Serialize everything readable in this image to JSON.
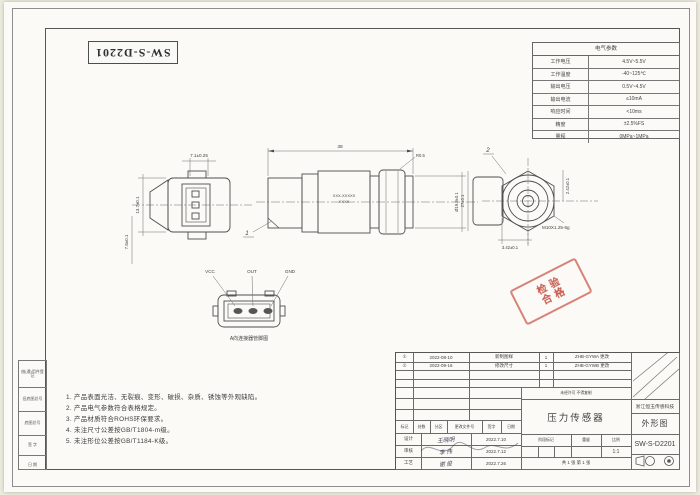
{
  "sheet": {
    "rotated_drawing_number": "SW-S-D2201",
    "line_color": "#4c4c4c",
    "stamp_color": "#c0392b"
  },
  "electrical_table": {
    "title": "电气参数",
    "rows": [
      [
        "工作电压",
        "4.5V~5.5V"
      ],
      [
        "工作温度",
        "-40~125℃"
      ],
      [
        "输出电压",
        "0.5V~4.5V"
      ],
      [
        "输出电流",
        "≤10mA"
      ],
      [
        "响应时间",
        "<10ms"
      ],
      [
        "精度",
        "±2.5%FS"
      ],
      [
        "量程",
        "0MPa~1MPa"
      ]
    ]
  },
  "views": {
    "left_view": {
      "dim_top": "7.1±0.25",
      "dim_left": "13.7±0.1",
      "dim_left2": "7.5±0.1"
    },
    "front_view": {
      "dim_width": "38",
      "leader_radius": "R0.5",
      "marking_line1": "XXX-XXXXX",
      "marking_line2": "XXXX",
      "dim_diameter": "Ø19.8±0.1",
      "balloon": "1"
    },
    "hex_view": {
      "balloon": "2",
      "dim_left": "27±0.1",
      "dim_bottom": "3.42±0.1",
      "dim_right": "2.42±0.1",
      "thread": "M10X1.25-6g"
    },
    "pin_view": {
      "pin_labels": [
        "VCC",
        "OUT",
        "GND"
      ],
      "caption": "A向连接器管脚图"
    }
  },
  "stamp": {
    "line1": "检验",
    "line2": "合格"
  },
  "notes": [
    "1. 产品表面光洁、无裂痕、变形、破损、杂质、锈蚀等外观缺陷。",
    "2. 产品电气参数符合表格规定。",
    "3. 产品材质符合ROHS环保要求。",
    "4. 未注尺寸公差按GB/T1804-m级。",
    "5. 未注形位公差按GB/T1184-K级。"
  ],
  "side_strip": [
    "借(通)用件登记",
    "旧底图总号",
    "底图总号",
    "签 字",
    "日 期"
  ],
  "title_block": {
    "revisions": [
      [
        "①",
        "2022-08-10",
        "新制图样",
        "1",
        "ZHB-GYWA 更改"
      ],
      [
        "②",
        "2022-09-16",
        "修改尺寸",
        "1",
        "ZHB-GYWB 更改"
      ]
    ],
    "header_cells": [
      "标记",
      "处数",
      "分区",
      "更改文件号",
      "签字",
      "日期"
    ],
    "sign_rows": [
      [
        "设计",
        "王晓明",
        "2022.7.10"
      ],
      [
        "审核",
        "李 伟",
        "2022.7.12"
      ],
      [
        "工艺",
        "谢 俊",
        "2022.7.26"
      ]
    ],
    "stage_header": [
      "阶段标记",
      "重量",
      "比例"
    ],
    "scale_value": "1:1",
    "sheet_info": "共 1 张  第 1 张",
    "confidential": "未经许可 不得复制",
    "product_name": "压力传感器",
    "company": "浙江恒玉传感科技",
    "doc_type": "外形图",
    "drawing_no": "SW-S-D2201"
  }
}
